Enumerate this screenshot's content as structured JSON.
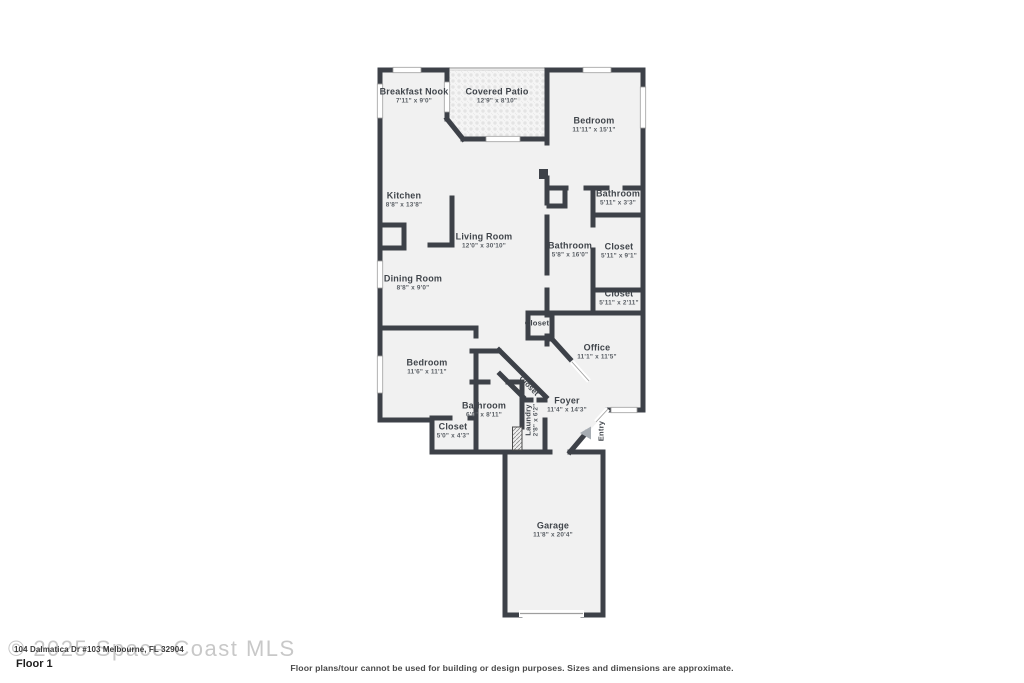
{
  "floor": {
    "label": "Floor 1"
  },
  "watermark": {
    "text": "© 2025 Space Coast MLS"
  },
  "address_overlay": {
    "text": "104 Dalmatica Dr #103 Melbourne, FL 32904"
  },
  "disclaimer": {
    "text": "Floor plans/tour cannot be used for building or design purposes. Sizes and dimensions are approximate."
  },
  "colors": {
    "wall": "#3d4148",
    "floor_fill": "#f1f1f1",
    "patio_fill": "#f4f4f4",
    "window_stroke": "#9e9e9e",
    "label_text": "#40454b",
    "entry_arrow": "#a7adb3",
    "watermark_gray": "#bfbfbf"
  },
  "rooms": [
    {
      "name": "Breakfast Nook",
      "dims": "7'11\" x 9'0\""
    },
    {
      "name": "Covered Patio",
      "dims": "12'9\" x 8'10\""
    },
    {
      "name": "Bedroom",
      "dims": "11'11\" x 15'1\""
    },
    {
      "name": "Kitchen",
      "dims": "8'8\" x 13'8\""
    },
    {
      "name": "Living Room",
      "dims": "12'0\" x 30'10\""
    },
    {
      "name": "Bathroom",
      "dims": "5'11\" x 3'3\""
    },
    {
      "name": "Bathroom",
      "dims": "5'8\" x 16'0\""
    },
    {
      "name": "Closet",
      "dims": "5'11\" x 9'1\""
    },
    {
      "name": "Closet",
      "dims": "5'11\" x 2'11\""
    },
    {
      "name": "Dining Room",
      "dims": "8'8\" x 9'0\""
    },
    {
      "name": "Closet",
      "dims": ""
    },
    {
      "name": "Office",
      "dims": "11'1\" x 11'5\""
    },
    {
      "name": "Bedroom",
      "dims": "11'6\" x 11'1\""
    },
    {
      "name": "Closet",
      "dims": ""
    },
    {
      "name": "Foyer",
      "dims": "11'4\" x 14'3\""
    },
    {
      "name": "Bathroom",
      "dims": "6'0\" x 8'11\""
    },
    {
      "name": "Closet",
      "dims": "5'0\" x 4'3\""
    },
    {
      "name": "Laundry",
      "dims": "2'8\" x 6'2\""
    },
    {
      "name": "Entry",
      "dims": ""
    },
    {
      "name": "Garage",
      "dims": "11'8\" x 20'4\""
    }
  ]
}
